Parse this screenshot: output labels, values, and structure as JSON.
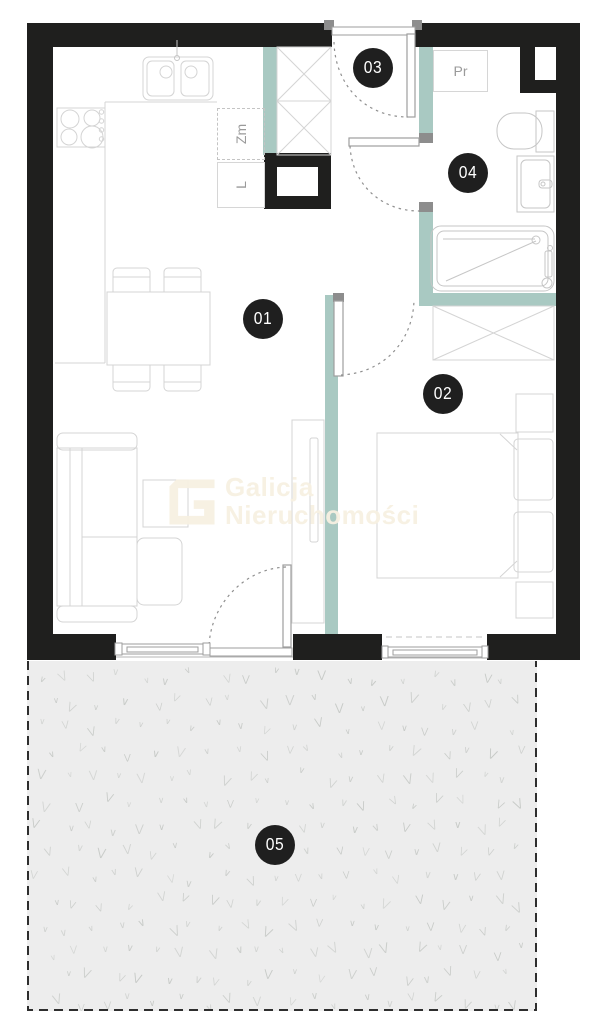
{
  "plan": {
    "rooms": [
      {
        "number": "01"
      },
      {
        "number": "02"
      },
      {
        "number": "03"
      },
      {
        "number": "04"
      },
      {
        "number": "05"
      }
    ],
    "appliance_labels": {
      "washing_machine": "Pr",
      "dishwasher": "Zm",
      "fridge": "L"
    },
    "watermark": {
      "line1": "Galicja",
      "line2": "Nieruchomości"
    },
    "colors": {
      "wall": "#1f1f1e",
      "accent_teal": "#a9c9c2",
      "garden_fill": "#ededed",
      "grass": "#c7cac7",
      "label_circle": "#1f1f1f",
      "furniture_line": "#d4d4d4",
      "fixture_line": "#c6c6c6",
      "window_line": "#9e9e9e",
      "hinge_block": "#8d8d8d",
      "watermark_text": "rgba(247,240,225,0.95)",
      "appliance_text": "#9a9a9a"
    }
  }
}
